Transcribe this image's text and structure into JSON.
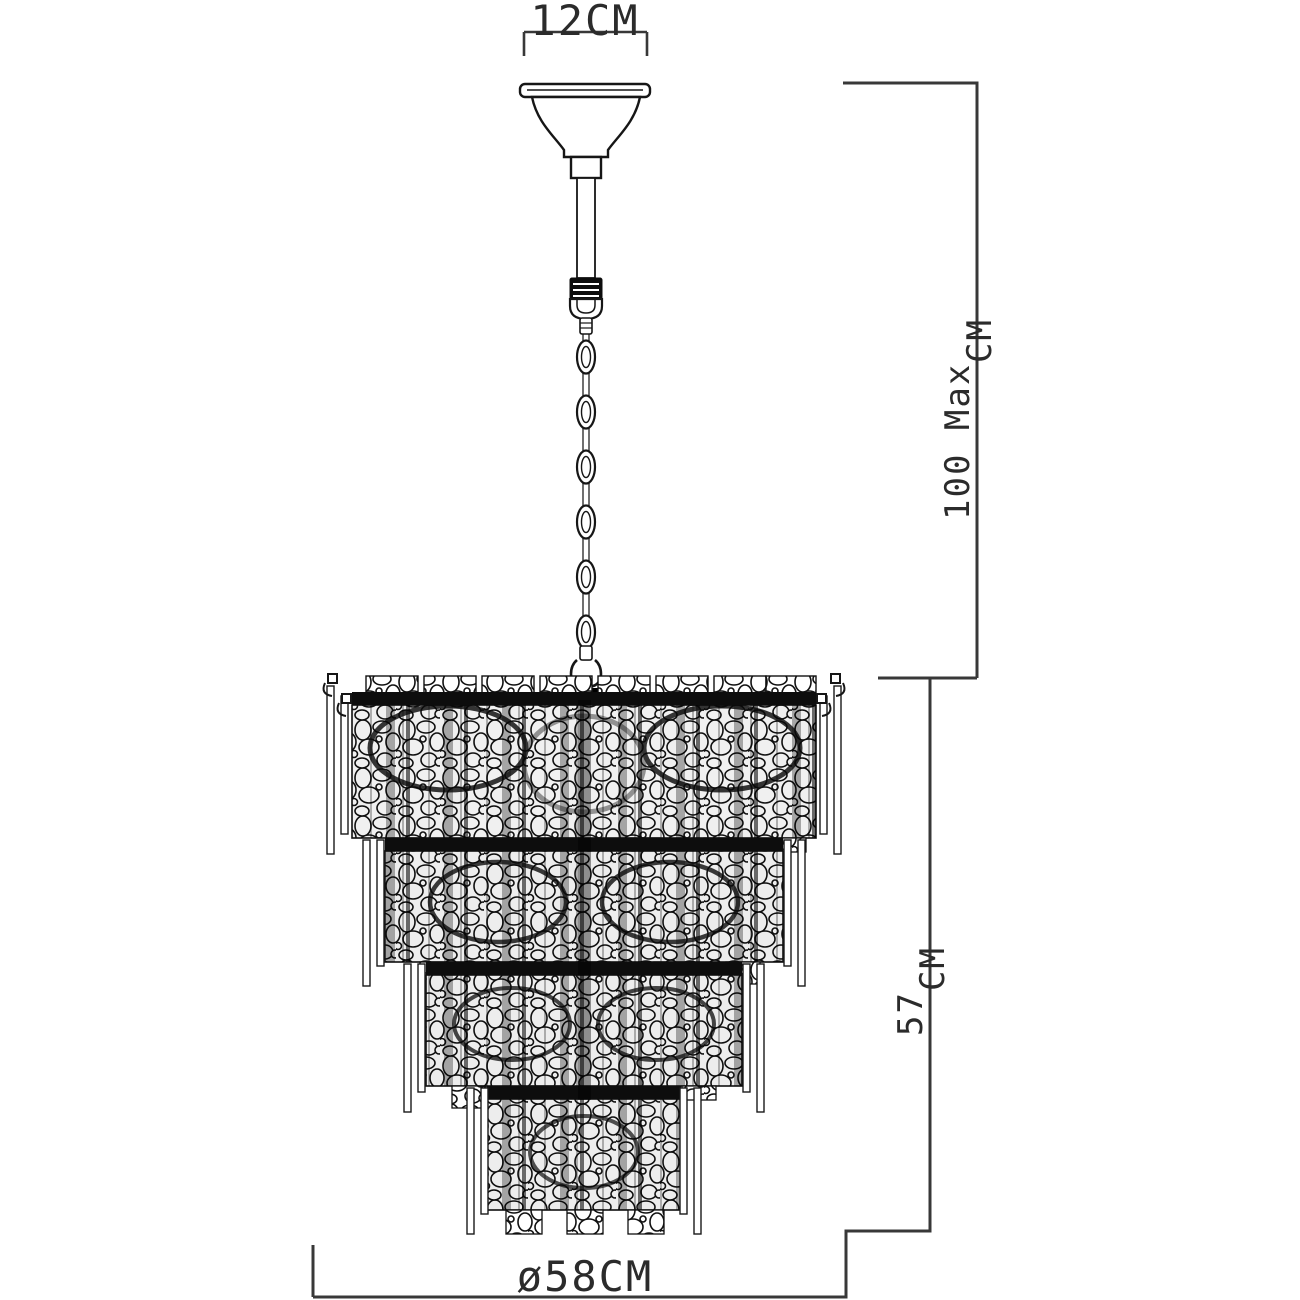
{
  "diagram": {
    "background_color": "#ffffff",
    "line_color": "#2d2d2d",
    "tier_count": 4,
    "chain_link_count": 6,
    "dimensions": {
      "canopy_width": {
        "label": "12CM"
      },
      "max_drop": {
        "value_text": "100 Max",
        "unit": "CM"
      },
      "fixture_height": {
        "value_text": "57",
        "unit": "CM"
      },
      "diameter": {
        "label": "ø58CM"
      }
    }
  }
}
